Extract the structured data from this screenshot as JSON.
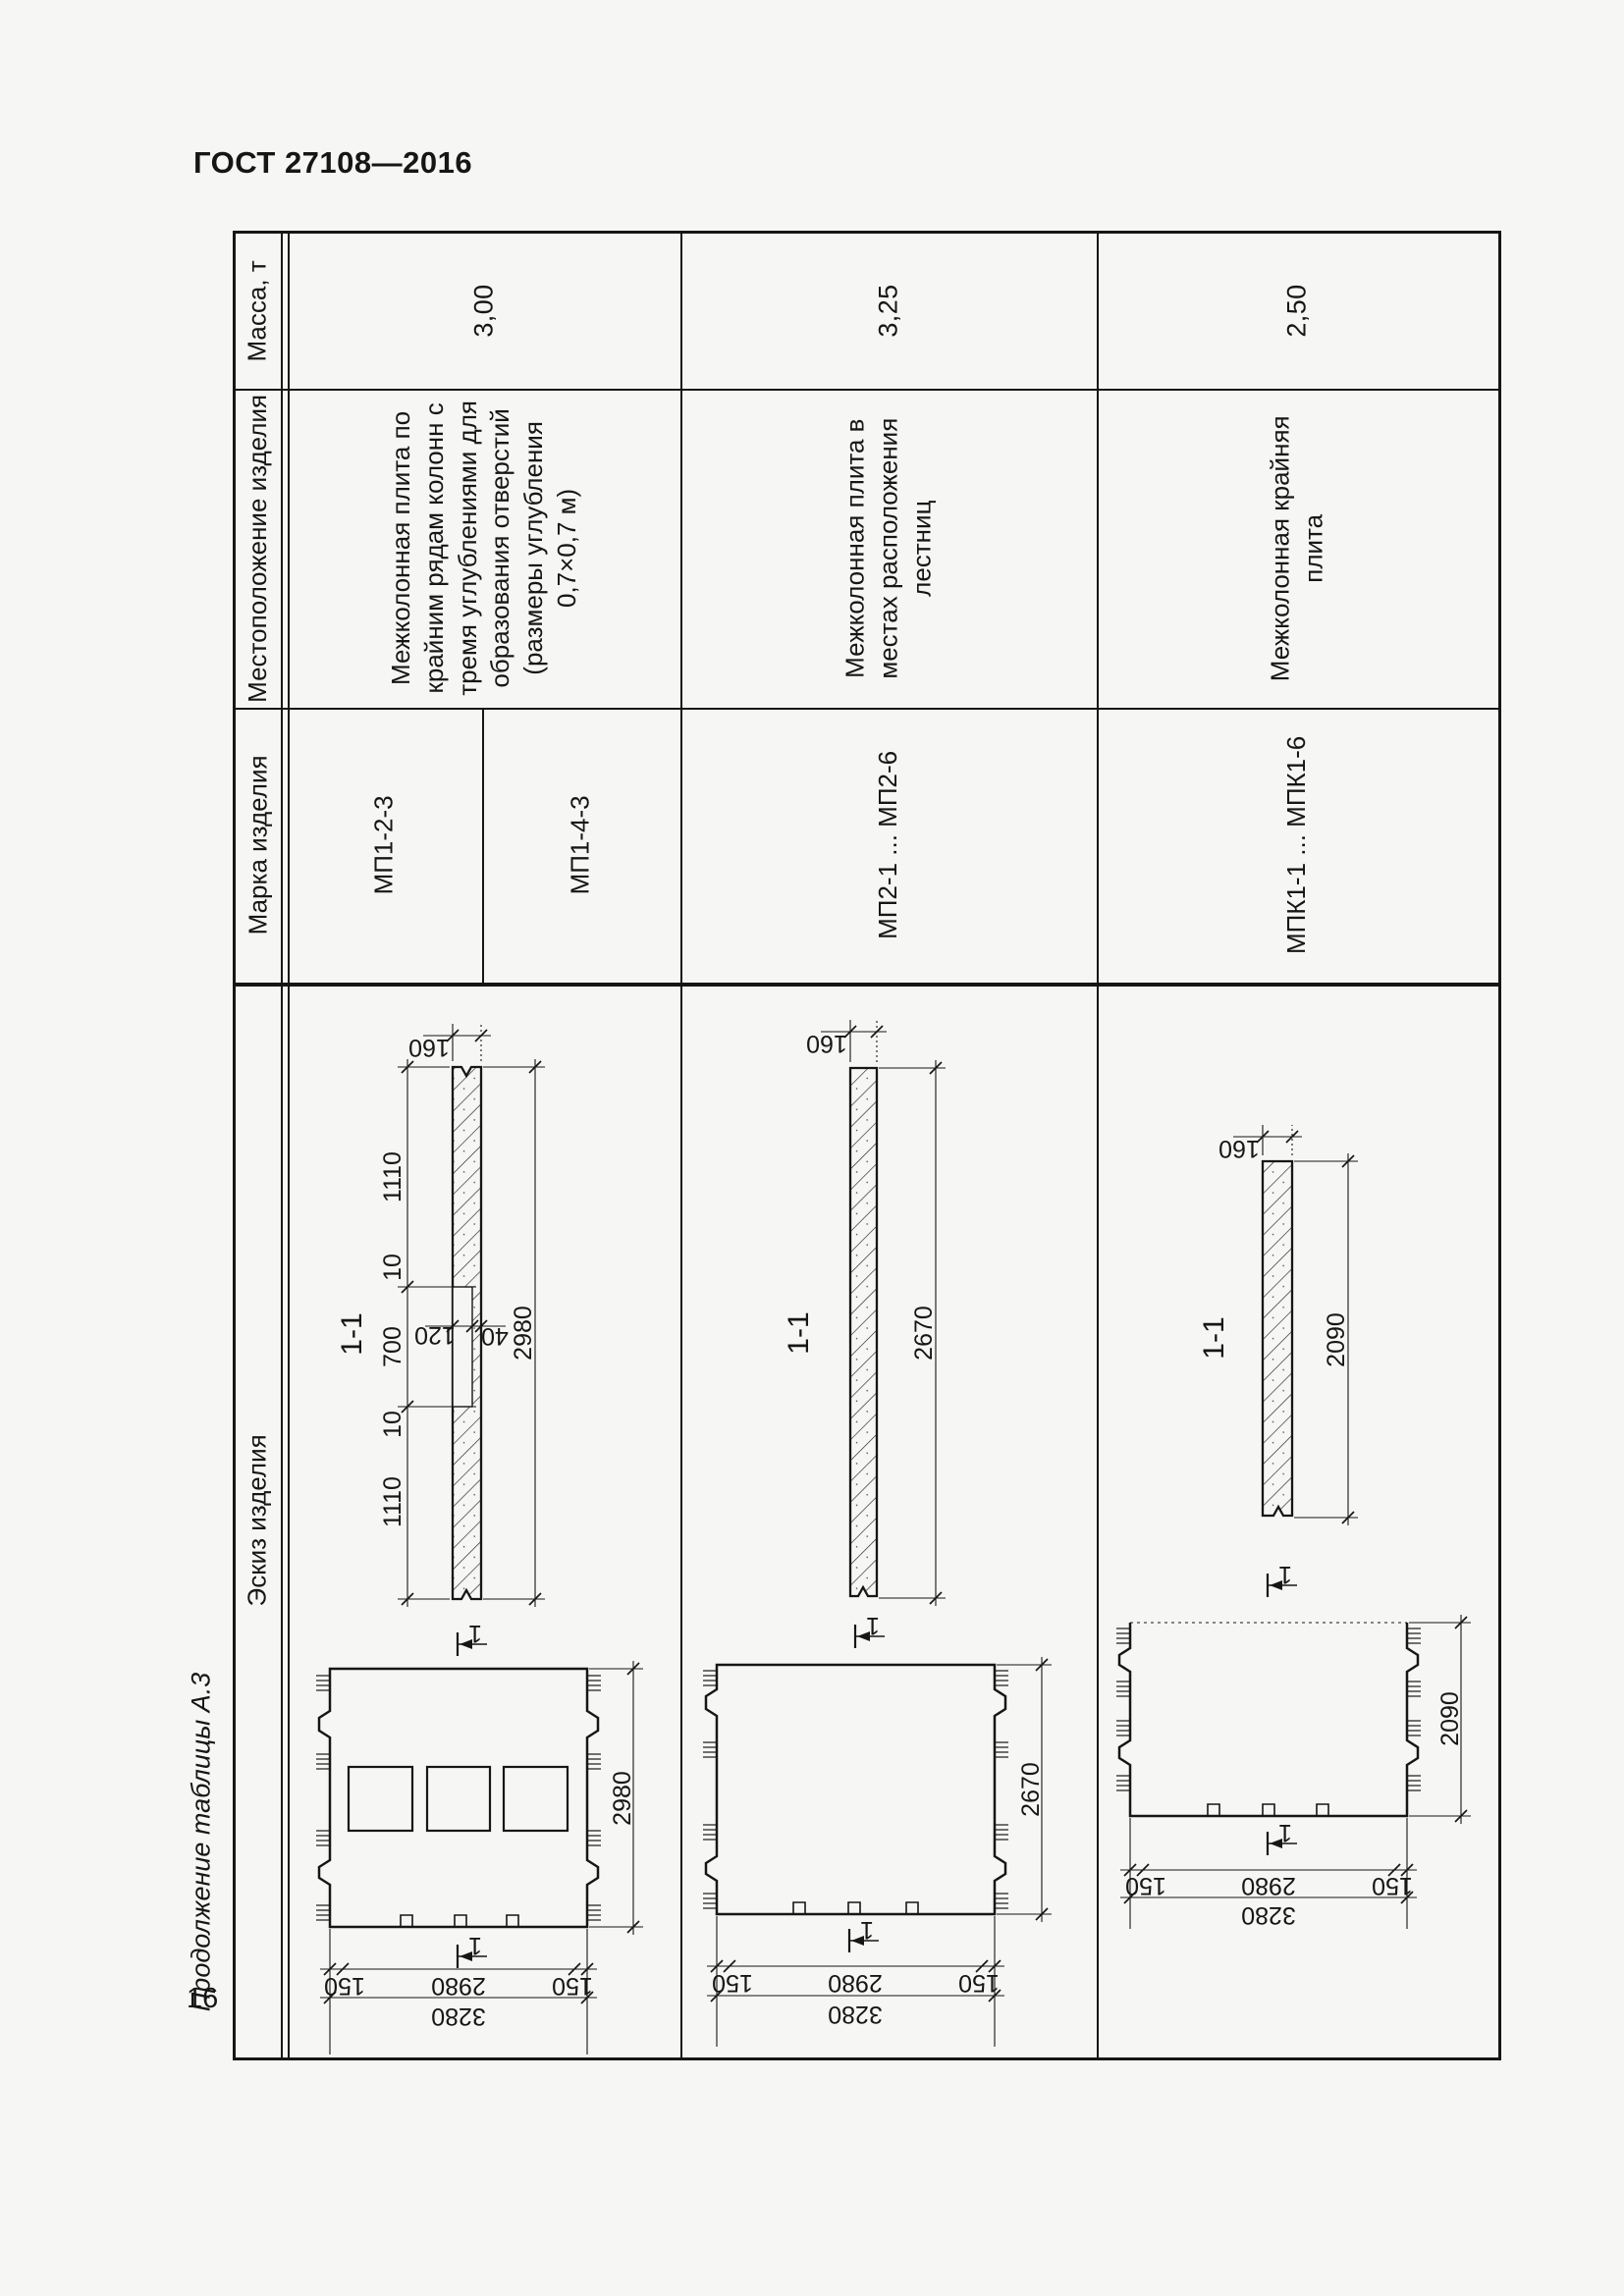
{
  "page": {
    "doc_code": "ГОСТ 27108—2016",
    "table_caption": "Продолжение таблицы А.3",
    "page_number": "16"
  },
  "table": {
    "row_headers": [
      "Масса, т",
      "Местоположение изделия",
      "Марка изделия",
      "Эскиз изделия"
    ],
    "products": [
      {
        "mass": "3,00",
        "location": "Межколонная плита по\nкрайним рядам колонн с\nтремя углублениями для\nобразования отверстий\n(размеры углубления\n0,7×0,7 м)",
        "marks": [
          "МП1-2-3",
          "МП1-4-3"
        ]
      },
      {
        "mass": "3,25",
        "location": "Межколонная плита в\nместах расположения\nлестниц",
        "marks": [
          "МП2-1 ... МП2-6"
        ]
      },
      {
        "mass": "2,50",
        "location": "Межколонная крайняя\nплита",
        "marks": [
          "МПК1-1 ... МПК1-6"
        ]
      }
    ]
  },
  "sketches": {
    "cut_label": "1",
    "s1": {
      "section_label": "1-1",
      "dim_thickness": "160",
      "dim_seg_a": "1110",
      "dim_seg_b": "10",
      "dim_seg_c": "700",
      "dim_seg_d": "10",
      "dim_seg_e": "1110",
      "dim_recess_depth": "120",
      "dim_recess_rest": "40",
      "dim_length": "2980",
      "plan_dim_height": "2980",
      "plan_dim_edge_l": "150",
      "plan_dim_mid": "2980",
      "plan_dim_edge_r": "150",
      "plan_dim_total": "3280"
    },
    "s2": {
      "section_label": "1-1",
      "dim_thickness": "160",
      "dim_length": "2670",
      "plan_dim_height": "2670",
      "plan_dim_edge_l": "150",
      "plan_dim_mid": "2980",
      "plan_dim_edge_r": "150",
      "plan_dim_total": "3280"
    },
    "s3": {
      "section_label": "1-1",
      "dim_thickness": "160",
      "dim_length": "2090",
      "plan_dim_height": "2090",
      "plan_dim_edge_l": "150",
      "plan_dim_mid": "2980",
      "plan_dim_edge_r": "150",
      "plan_dim_total": "3280"
    }
  }
}
